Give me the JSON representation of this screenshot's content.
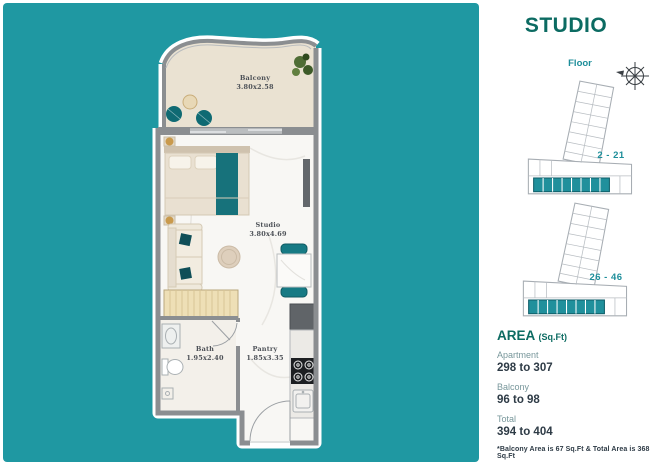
{
  "title": "STUDIO",
  "colors": {
    "background_teal": "#1f98a2",
    "title_teal": "#0c6b62",
    "accent_teal": "#1d8e9a",
    "value_dark": "#2e3b46",
    "label_muted": "#78979b",
    "furniture_teal": "#177a84",
    "wall_gray": "#8b8e91"
  },
  "floor_section": {
    "label": "Floor",
    "plates": [
      {
        "range": "2 - 21"
      },
      {
        "range": "26 - 46"
      }
    ]
  },
  "plan": {
    "rooms": [
      {
        "name": "Balcony",
        "dims": "3.80x2.58"
      },
      {
        "name": "Studio",
        "dims": "3.80x4.69"
      },
      {
        "name": "Bath",
        "dims": "1.95x2.40"
      },
      {
        "name": "Pantry",
        "dims": "1.85x3.35"
      }
    ]
  },
  "area_section": {
    "heading": "AREA",
    "unit": "(Sq.Ft)",
    "rows": [
      {
        "label": "Apartment",
        "value": "298 to 307"
      },
      {
        "label": "Balcony",
        "value": "96 to 98"
      },
      {
        "label": "Total",
        "value": "394 to 404"
      }
    ],
    "note": "*Balcony Area is 67 Sq.Ft & Total Area is 368 Sq.Ft"
  }
}
